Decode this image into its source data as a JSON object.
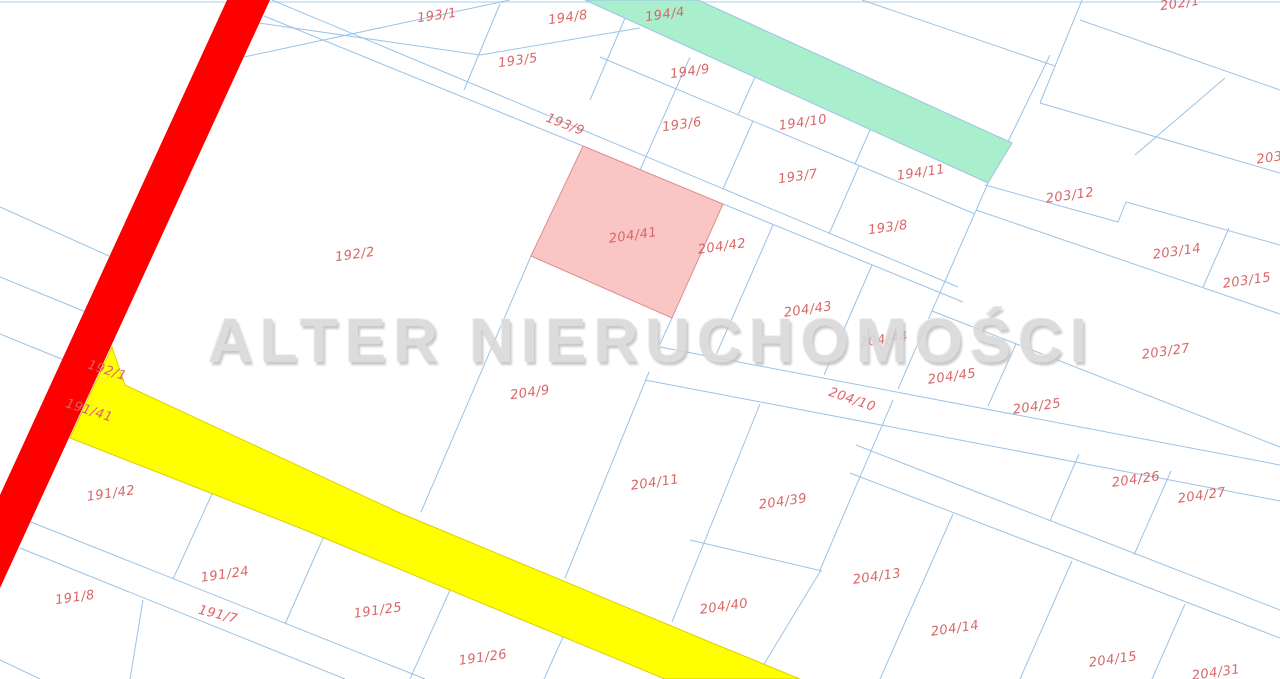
{
  "map": {
    "background": "#ffffff",
    "line_color": "#9cc3e6",
    "top_border_color": "#d3e7f5",
    "label_color": "#d96666",
    "watermark": {
      "text": "ALTER NIERUCHOMOŚCI",
      "color": "#d9d9d9"
    },
    "features": {
      "red_road": {
        "name": "red-road",
        "fill": "#fe0000",
        "stroke": "none",
        "points": "227,0 270,0 0,588 0,495"
      },
      "green_road": {
        "name": "green-road",
        "fill": "#a9efcd",
        "stroke": "#9cc3e6",
        "points": "585,0 698,0 1012,143 988,183",
        "label": "194/4"
      },
      "yellow_road": {
        "name": "yellow-road",
        "fill": "#ffff00",
        "stroke": "#ddd000",
        "points": "112,347 125,385 400,513 705,640 800,679 665,679 300,528 70,438"
      },
      "highlight_parcel": {
        "name": "highlighted-parcel",
        "fill": "#f9c5c5",
        "stroke": "#dd8e8e",
        "points": "583,146 723,204 672,318 531,256",
        "label": "204/41"
      }
    },
    "boundary_lines": [
      "510,0 244,57",
      "259,23 480,55 640,28",
      "272,0 958,287",
      "264,16 583,146",
      "723,204 963,302",
      "600,57 975,214",
      "625,18 590,100",
      "755,77 738,115",
      "871,128 855,164",
      "690,57 637,177",
      "500,4 464,90",
      "753,121 723,189",
      "859,166 829,234",
      "1050,55 988,183 932,311 898,389",
      "1082,0 1040,103",
      "1225,78 1135,155",
      "1080,20 1280,90",
      "862,0 1055,66",
      "1040,103 1280,173",
      "985,185 1118,222 1126,202 1280,245",
      "976,210 1280,314",
      "1229,228 1203,287",
      "932,311 1280,447",
      "1016,344 988,406",
      "773,225 716,355",
      "872,265 824,375",
      "672,318 660,344",
      "531,256 421,512",
      "649,372 565,578",
      "660,347 1280,465",
      "645,380 1280,501",
      "1171,471 1134,555",
      "1079,454 1050,521",
      "856,445 1280,610",
      "850,473 1280,638",
      "893,400 820,570",
      "760,404 672,622",
      "690,540 822,571",
      "821,570 755,679",
      "953,514 880,679",
      "1072,561 1020,679",
      "1185,604 1152,679",
      "0,207 109,256",
      "0,277 86,312",
      "0,334 64,360",
      "31,522 425,679",
      "20,548 345,679",
      "212,494 173,579",
      "324,536 285,624",
      "450,590 410,679",
      "563,637 544,679",
      "143,600 130,679",
      "0,660 40,679"
    ],
    "parcels": [
      {
        "label": "193/1",
        "x": 437,
        "y": 16,
        "rot": -8
      },
      {
        "label": "194/8",
        "x": 568,
        "y": 18,
        "rot": -8
      },
      {
        "label": "194/4",
        "x": 665,
        "y": 15,
        "rot": -8
      },
      {
        "label": "202/1",
        "x": 1180,
        "y": 4,
        "rot": -8
      },
      {
        "label": "193/5",
        "x": 518,
        "y": 61,
        "rot": -8
      },
      {
        "label": "194/9",
        "x": 690,
        "y": 72,
        "rot": -8
      },
      {
        "label": "193/9",
        "x": 565,
        "y": 125,
        "rot": 21
      },
      {
        "label": "193/6",
        "x": 682,
        "y": 125,
        "rot": -8
      },
      {
        "label": "194/10",
        "x": 803,
        "y": 123,
        "rot": -8
      },
      {
        "label": "193/7",
        "x": 798,
        "y": 177,
        "rot": -8
      },
      {
        "label": "194/11",
        "x": 921,
        "y": 173,
        "rot": -8
      },
      {
        "label": "203/12",
        "x": 1070,
        "y": 196,
        "rot": -8
      },
      {
        "label": "203/",
        "x": 1272,
        "y": 158,
        "rot": -8
      },
      {
        "label": "193/8",
        "x": 888,
        "y": 228,
        "rot": -8
      },
      {
        "label": "204/41",
        "x": 633,
        "y": 236,
        "rot": -8
      },
      {
        "label": "204/42",
        "x": 722,
        "y": 247,
        "rot": -8
      },
      {
        "label": "203/14",
        "x": 1177,
        "y": 252,
        "rot": -8
      },
      {
        "label": "192/2",
        "x": 355,
        "y": 255,
        "rot": -8
      },
      {
        "label": "203/15",
        "x": 1247,
        "y": 281,
        "rot": -8
      },
      {
        "label": "204/43",
        "x": 808,
        "y": 310,
        "rot": -8
      },
      {
        "label": "204/44",
        "x": 884,
        "y": 340,
        "rot": -8
      },
      {
        "label": "203/27",
        "x": 1166,
        "y": 352,
        "rot": -8
      },
      {
        "label": "192/1",
        "x": 107,
        "y": 371,
        "rot": 18
      },
      {
        "label": "204/45",
        "x": 952,
        "y": 377,
        "rot": -8
      },
      {
        "label": "204/9",
        "x": 530,
        "y": 393,
        "rot": -8
      },
      {
        "label": "204/25",
        "x": 1037,
        "y": 407,
        "rot": -8
      },
      {
        "label": "191/41",
        "x": 89,
        "y": 411,
        "rot": 18
      },
      {
        "label": "204/10",
        "x": 852,
        "y": 400,
        "rot": 19
      },
      {
        "label": "204/26",
        "x": 1136,
        "y": 480,
        "rot": -8
      },
      {
        "label": "204/27",
        "x": 1202,
        "y": 496,
        "rot": -8
      },
      {
        "label": "204/11",
        "x": 655,
        "y": 483,
        "rot": -8
      },
      {
        "label": "191/42",
        "x": 111,
        "y": 494,
        "rot": -8
      },
      {
        "label": "204/39",
        "x": 783,
        "y": 502,
        "rot": -8
      },
      {
        "label": "191/24",
        "x": 225,
        "y": 575,
        "rot": -8
      },
      {
        "label": "204/13",
        "x": 877,
        "y": 577,
        "rot": -8
      },
      {
        "label": "191/8",
        "x": 75,
        "y": 598,
        "rot": -8
      },
      {
        "label": "191/7",
        "x": 218,
        "y": 615,
        "rot": 14
      },
      {
        "label": "191/25",
        "x": 378,
        "y": 611,
        "rot": -8
      },
      {
        "label": "204/40",
        "x": 724,
        "y": 607,
        "rot": -8
      },
      {
        "label": "204/14",
        "x": 955,
        "y": 629,
        "rot": -8
      },
      {
        "label": "191/26",
        "x": 483,
        "y": 658,
        "rot": -8
      },
      {
        "label": "204/15",
        "x": 1113,
        "y": 660,
        "rot": -8
      },
      {
        "label": "204/31",
        "x": 1216,
        "y": 673,
        "rot": -8
      }
    ]
  }
}
